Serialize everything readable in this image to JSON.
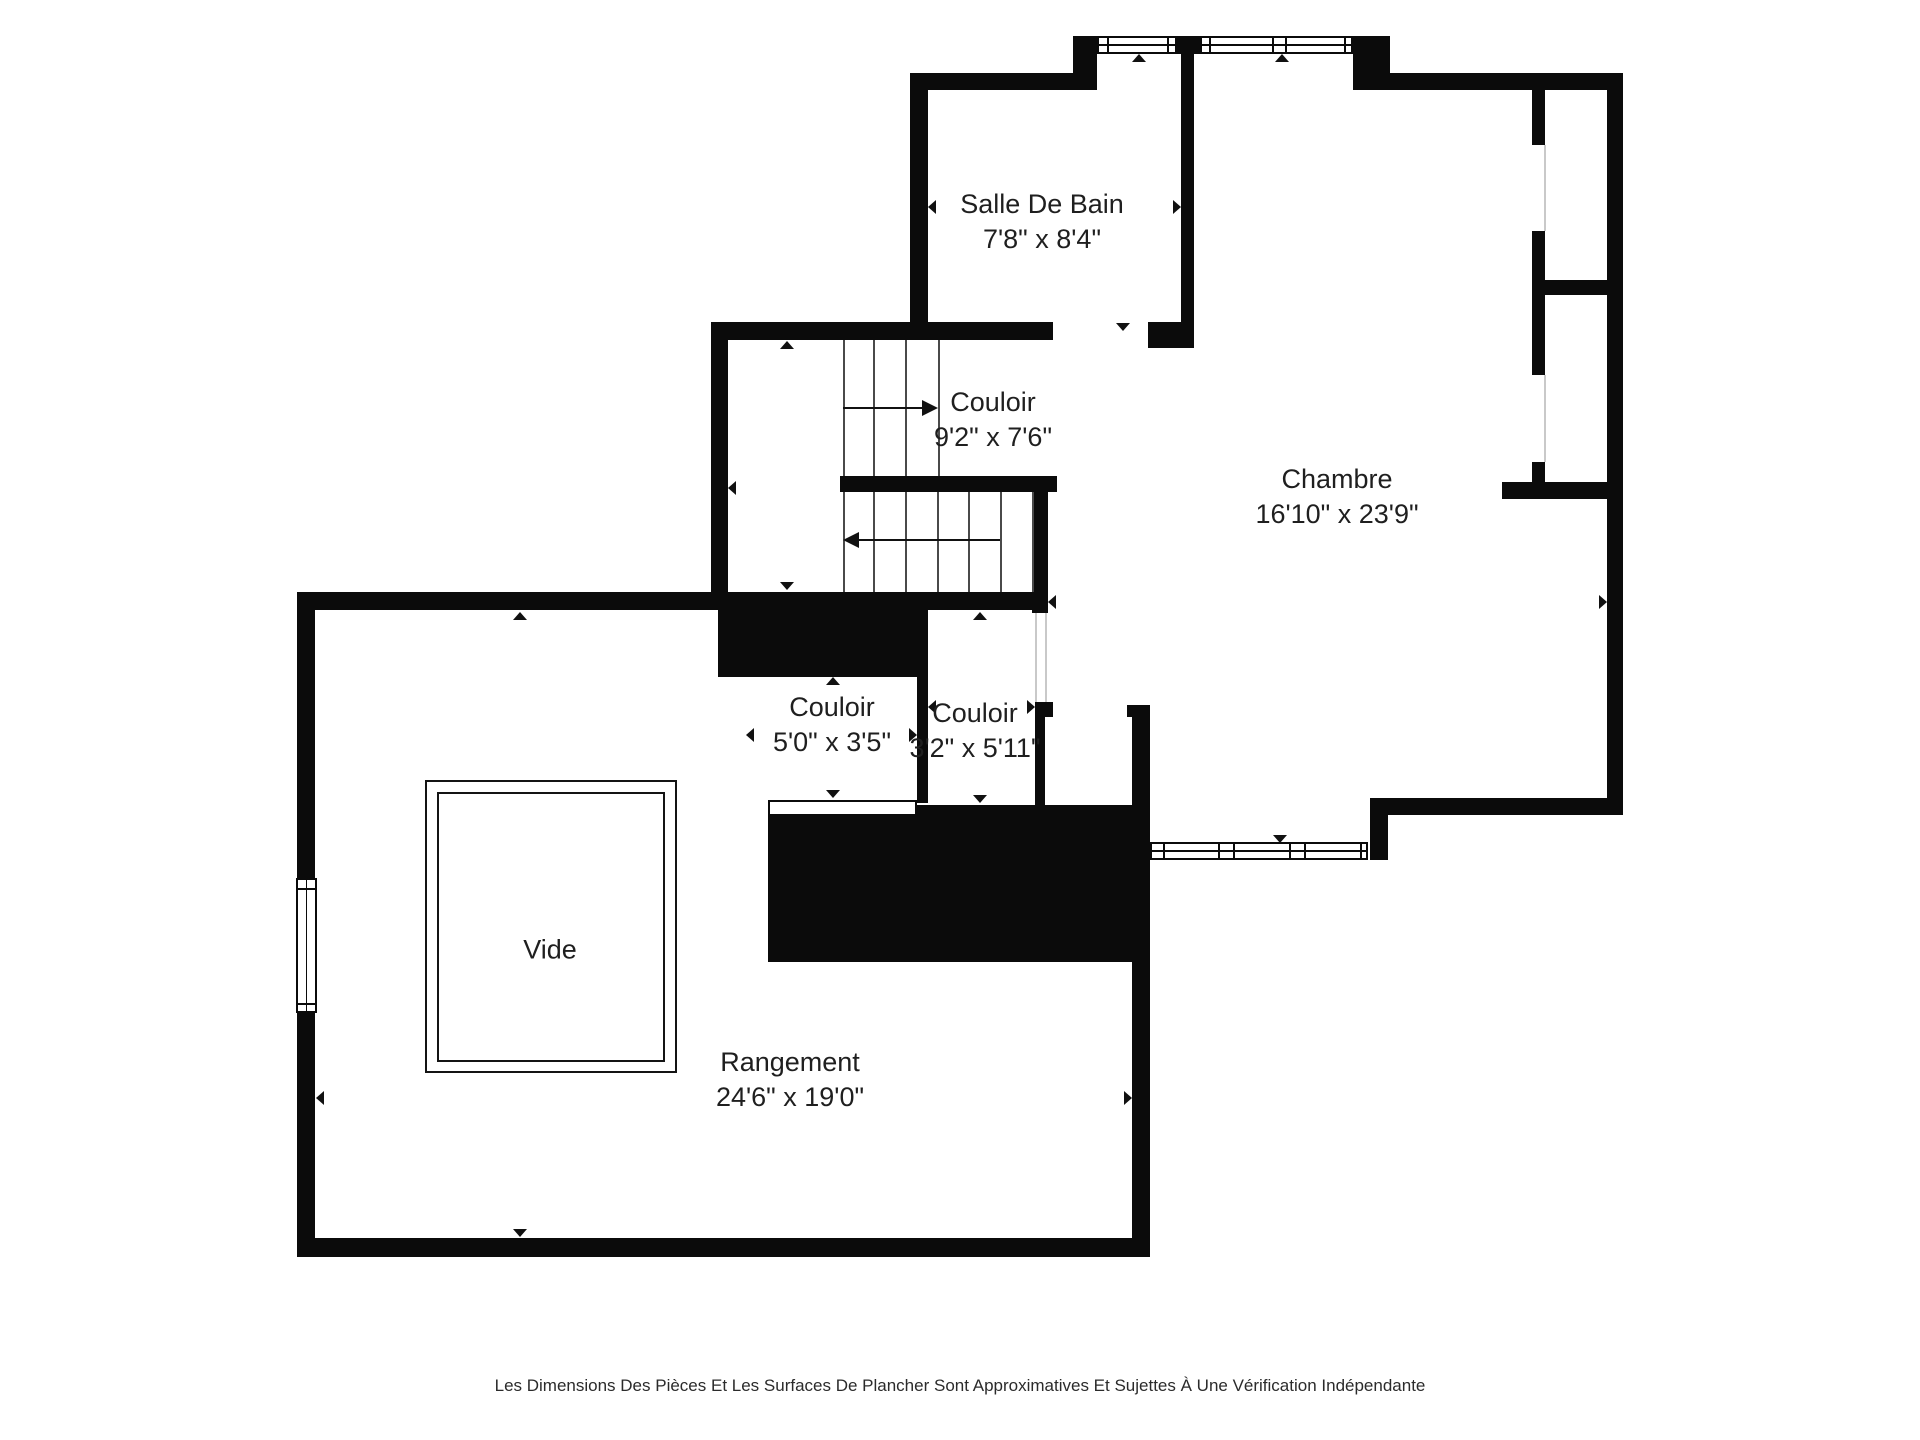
{
  "footer": {
    "text": "Les Dimensions Des Pièces Et Les Surfaces De Plancher Sont Approximatives Et Sujettes À Une Vérification Indépendante"
  },
  "rooms": [
    {
      "id": "salle-de-bain",
      "name": "Salle De Bain",
      "dims": "7'8\" x 8'4\"",
      "cx": 1042,
      "cy": 222
    },
    {
      "id": "couloir-escalier",
      "name": "Couloir",
      "dims": "9'2\" x 7'6\"",
      "cx": 993,
      "cy": 420
    },
    {
      "id": "chambre",
      "name": "Chambre",
      "dims": "16'10\" x 23'9\"",
      "cx": 1337,
      "cy": 497
    },
    {
      "id": "couloir-centre",
      "name": "Couloir",
      "dims": "5'0\" x 3'5\"",
      "cx": 832,
      "cy": 725
    },
    {
      "id": "couloir-est",
      "name": "Couloir",
      "dims": "3'2\" x 5'11\"",
      "cx": 975,
      "cy": 731
    },
    {
      "id": "vide",
      "name": "Vide",
      "dims": "",
      "cx": 550,
      "cy": 950
    },
    {
      "id": "rangement",
      "name": "Rangement",
      "dims": "24'6\" x 19'0\"",
      "cx": 790,
      "cy": 1080
    }
  ],
  "colors": {
    "wall": "#0b0b0b",
    "text": "#1f1f1f",
    "tread": "#4a4a4a",
    "faint": "#c9c9c9"
  },
  "geometry": {
    "walls": [
      [
        910,
        73,
        163,
        17
      ],
      [
        1073,
        36,
        24,
        54
      ],
      [
        1177,
        36,
        23,
        18
      ],
      [
        1353,
        36,
        37,
        54
      ],
      [
        1353,
        73,
        270,
        17
      ],
      [
        1607,
        73,
        16,
        742
      ],
      [
        1388,
        798,
        235,
        17
      ],
      [
        1370,
        798,
        18,
        62
      ],
      [
        910,
        73,
        18,
        267
      ],
      [
        711,
        322,
        342,
        18
      ],
      [
        1148,
        322,
        46,
        26
      ],
      [
        1181,
        54,
        13,
        294
      ],
      [
        711,
        322,
        17,
        288
      ],
      [
        840,
        476,
        217,
        16
      ],
      [
        1032,
        492,
        16,
        121
      ],
      [
        297,
        592,
        751,
        18
      ],
      [
        718,
        605,
        210,
        72
      ],
      [
        917,
        677,
        11,
        126
      ],
      [
        768,
        805,
        380,
        157
      ],
      [
        1035,
        702,
        18,
        15
      ],
      [
        1035,
        717,
        10,
        88
      ],
      [
        1127,
        705,
        18,
        12
      ],
      [
        1132,
        705,
        18,
        552
      ],
      [
        297,
        592,
        18,
        665
      ],
      [
        297,
        1238,
        851,
        19
      ],
      [
        1532,
        88,
        13,
        57
      ],
      [
        1532,
        231,
        13,
        144
      ],
      [
        1545,
        280,
        65,
        15
      ],
      [
        1532,
        462,
        13,
        20
      ],
      [
        1502,
        482,
        121,
        17
      ]
    ],
    "windows": [
      {
        "x": 1097,
        "y": 36,
        "w": 80,
        "h": 18,
        "orient": "h",
        "mullions": [
          0.1,
          0.9
        ]
      },
      {
        "x": 1200,
        "y": 36,
        "w": 153,
        "h": 18,
        "orient": "h",
        "mullions": [
          0.05,
          0.47,
          0.56,
          0.95
        ]
      },
      {
        "x": 1150,
        "y": 842,
        "w": 218,
        "h": 18,
        "orient": "h",
        "mullions": [
          0.05,
          0.31,
          0.38,
          0.64,
          0.71,
          0.97
        ]
      },
      {
        "x": 296,
        "y": 878,
        "w": 21,
        "h": 135,
        "orient": "v",
        "mullions": [
          0.06,
          0.94
        ]
      }
    ],
    "threshold": {
      "x": 768,
      "y": 800,
      "w": 149,
      "h": 16
    },
    "vide": {
      "outer": [
        425,
        780,
        252,
        293
      ],
      "inner": [
        437,
        792,
        228,
        270
      ]
    },
    "stairs": [
      {
        "x1": 843,
        "x2": 938,
        "y1": 340,
        "y2": 476,
        "treads": [
          873,
          905
        ],
        "arrow": {
          "y": 408,
          "x1": 843,
          "x2": 938,
          "head": "right"
        }
      },
      {
        "x1": 843,
        "x2": 1032,
        "y1": 492,
        "y2": 592,
        "treads": [
          873,
          905,
          937,
          968,
          1000
        ],
        "arrow": {
          "y": 540,
          "x1": 843,
          "x2": 1000,
          "head": "left"
        }
      }
    ],
    "faint_lines": [
      {
        "x": 1544,
        "y1": 145,
        "y2": 231
      },
      {
        "x": 1544,
        "y1": 375,
        "y2": 462
      },
      {
        "x": 1035,
        "y1": 613,
        "y2": 702
      },
      {
        "x": 1045,
        "y1": 613,
        "y2": 702
      }
    ],
    "markers": [
      {
        "d": "up",
        "x": 1139,
        "y": 54
      },
      {
        "d": "up",
        "x": 1282,
        "y": 54
      },
      {
        "d": "left",
        "x": 928,
        "y": 207
      },
      {
        "d": "right",
        "x": 1181,
        "y": 207
      },
      {
        "d": "down",
        "x": 1123,
        "y": 331
      },
      {
        "d": "up",
        "x": 787,
        "y": 341
      },
      {
        "d": "left",
        "x": 728,
        "y": 488
      },
      {
        "d": "down",
        "x": 787,
        "y": 590
      },
      {
        "d": "left",
        "x": 1048,
        "y": 602
      },
      {
        "d": "right",
        "x": 1607,
        "y": 602
      },
      {
        "d": "down",
        "x": 1280,
        "y": 843
      },
      {
        "d": "up",
        "x": 833,
        "y": 677
      },
      {
        "d": "left",
        "x": 746,
        "y": 735
      },
      {
        "d": "right",
        "x": 917,
        "y": 735
      },
      {
        "d": "down",
        "x": 833,
        "y": 798
      },
      {
        "d": "up",
        "x": 980,
        "y": 612
      },
      {
        "d": "left",
        "x": 928,
        "y": 707
      },
      {
        "d": "right",
        "x": 1035,
        "y": 707
      },
      {
        "d": "down",
        "x": 980,
        "y": 803
      },
      {
        "d": "up",
        "x": 520,
        "y": 612
      },
      {
        "d": "down",
        "x": 520,
        "y": 1237
      },
      {
        "d": "left",
        "x": 316,
        "y": 1098
      },
      {
        "d": "right",
        "x": 1132,
        "y": 1098
      }
    ]
  }
}
